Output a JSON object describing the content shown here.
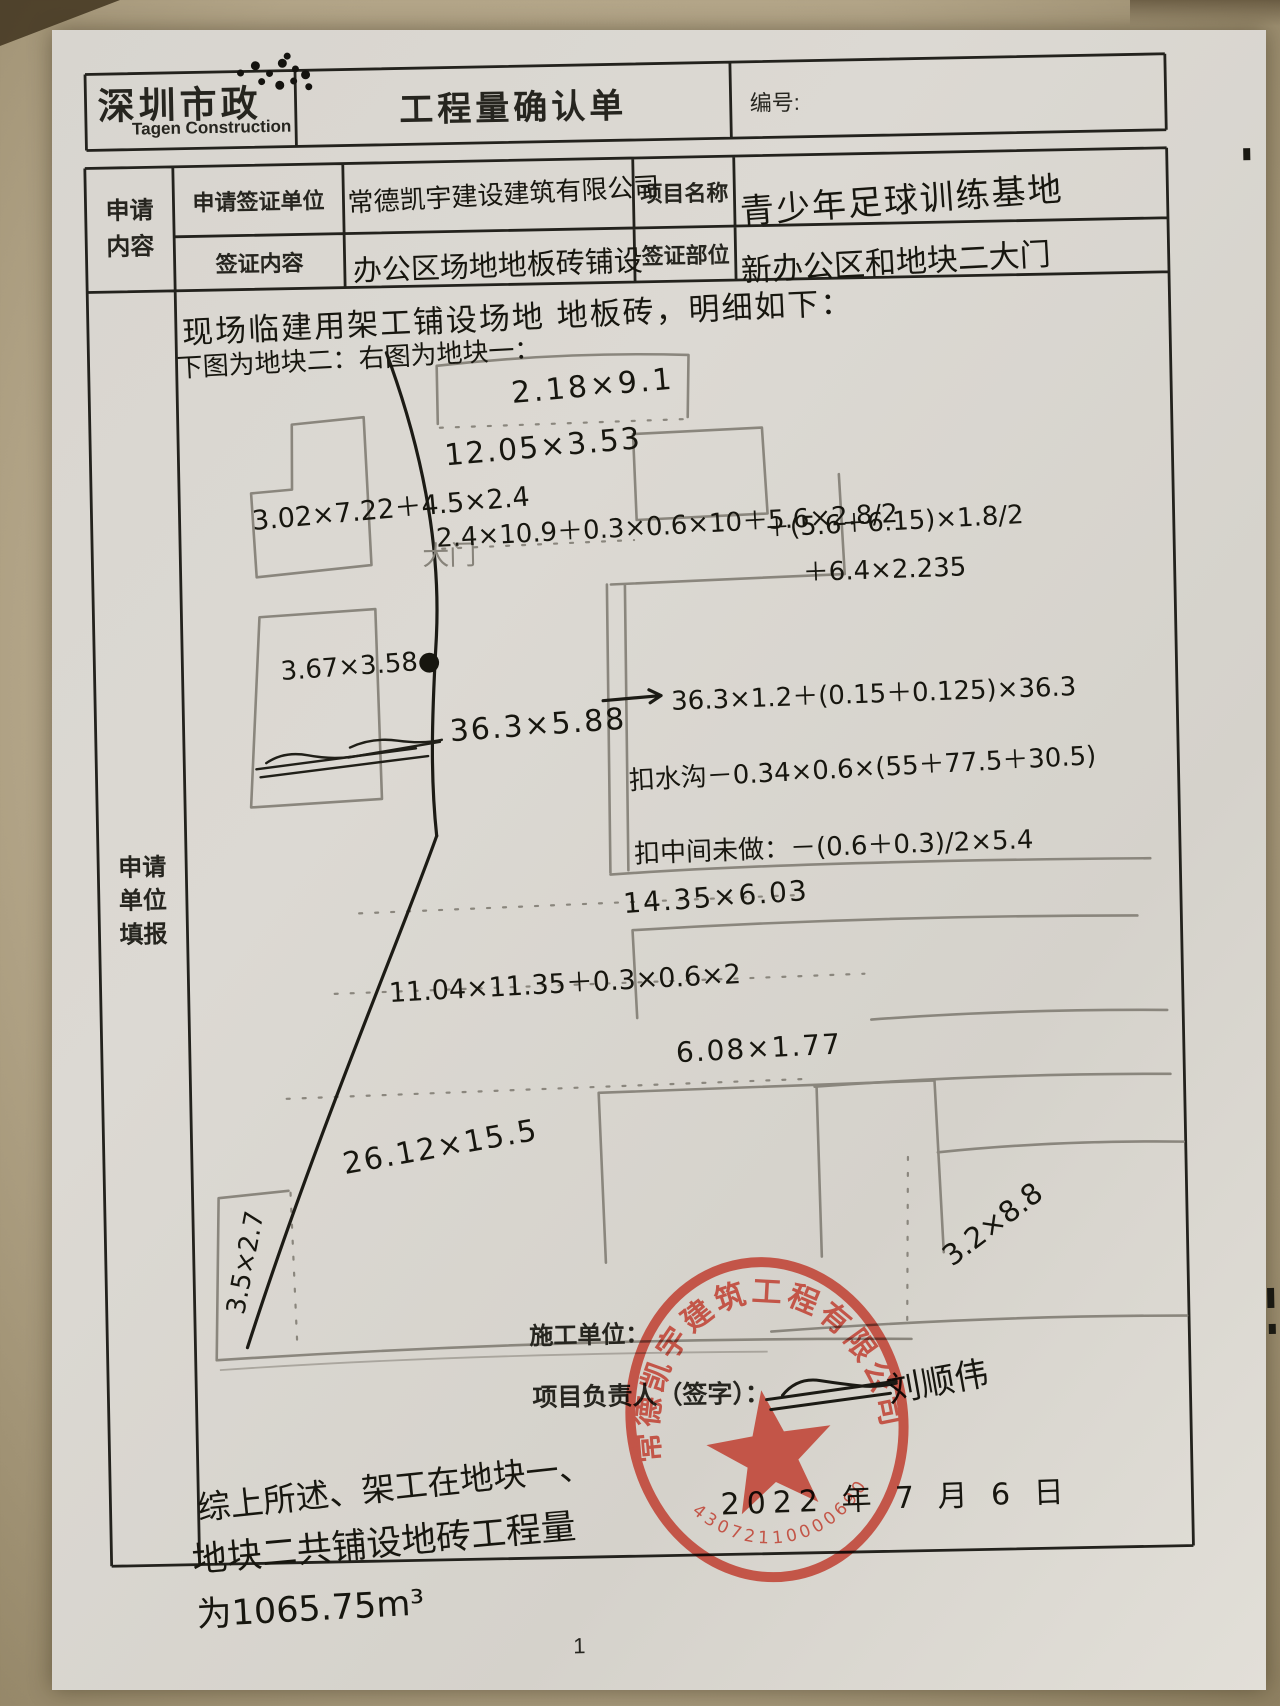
{
  "header": {
    "logo_title": "深圳市政",
    "logo_subtitle": "Tagen Construction",
    "form_title": "工程量确认单",
    "number_label": "编号:"
  },
  "form": {
    "section_label": "申请 内容",
    "filler_label_1": "申请",
    "filler_label_2": "单位",
    "filler_label_3": "填报",
    "section_label_1": "申请",
    "section_label_2": "内容",
    "row1": {
      "label_a": "申请签证单位",
      "value_a": "常德凯宇建设建筑有限公司",
      "label_b": "项目名称",
      "value_b": "青少年足球训练基地"
    },
    "row2": {
      "label_a": "签证内容",
      "value_a": "办公区场地地板砖铺设",
      "label_b": "签证部位",
      "value_b": "新办公区和地块二大门"
    }
  },
  "notes": {
    "intro": "现场临建用架工铺设场地 地板砖，明细如下：",
    "left_fig_label": "下图为地块二：",
    "right_fig_label": "右图为地块一：",
    "gate_label": "大门"
  },
  "measurements": {
    "block2_top": "3.02×7.22＋4.5×2.4",
    "block2_mid": "3.67×3.58●",
    "m_top": "2.18×9.1",
    "m_row2": "12.05×3.53",
    "m_formula": "2.4×10.9＋0.3×0.6×10＋5.6×2.8/2",
    "m_formula_b": "＋(5.6＋6.15)×1.8/2",
    "m_formula_c": "＋6.4×2.235",
    "m_arrow": "36.3×1.2＋(0.15＋0.125)×36.3",
    "m_strip": "36.3×5.88",
    "deduct_gutter": "扣水沟－0.34×0.6×(55＋77.5＋30.5)",
    "deduct_middle": "扣中间未做：－(0.6＋0.3)/2×5.4",
    "m_mid": "14.35×6.03",
    "m_mid2": "11.04×11.35＋0.3×0.6×2",
    "m_low": "6.08×1.77",
    "m_big": "26.12×15.5",
    "m_small_rect": "3.5×2.7",
    "m_stamp_area": "3.2×8.8"
  },
  "footer": {
    "builder_label": "施工单位：",
    "manager_label": "项目负责人（签字）：",
    "signature": "刘顺伟",
    "date": "2022 年 7 月 6 日",
    "conclusion_1": "综上所述、架工在地块一、",
    "conclusion_2": "地块二共铺设地砖工程量",
    "conclusion_3": "为1065.75m³",
    "page_number": "1"
  },
  "stamp": {
    "company": "常德凯宇建筑工程有限公司",
    "serial": "43072110000690",
    "color": "#bf3a2b"
  }
}
